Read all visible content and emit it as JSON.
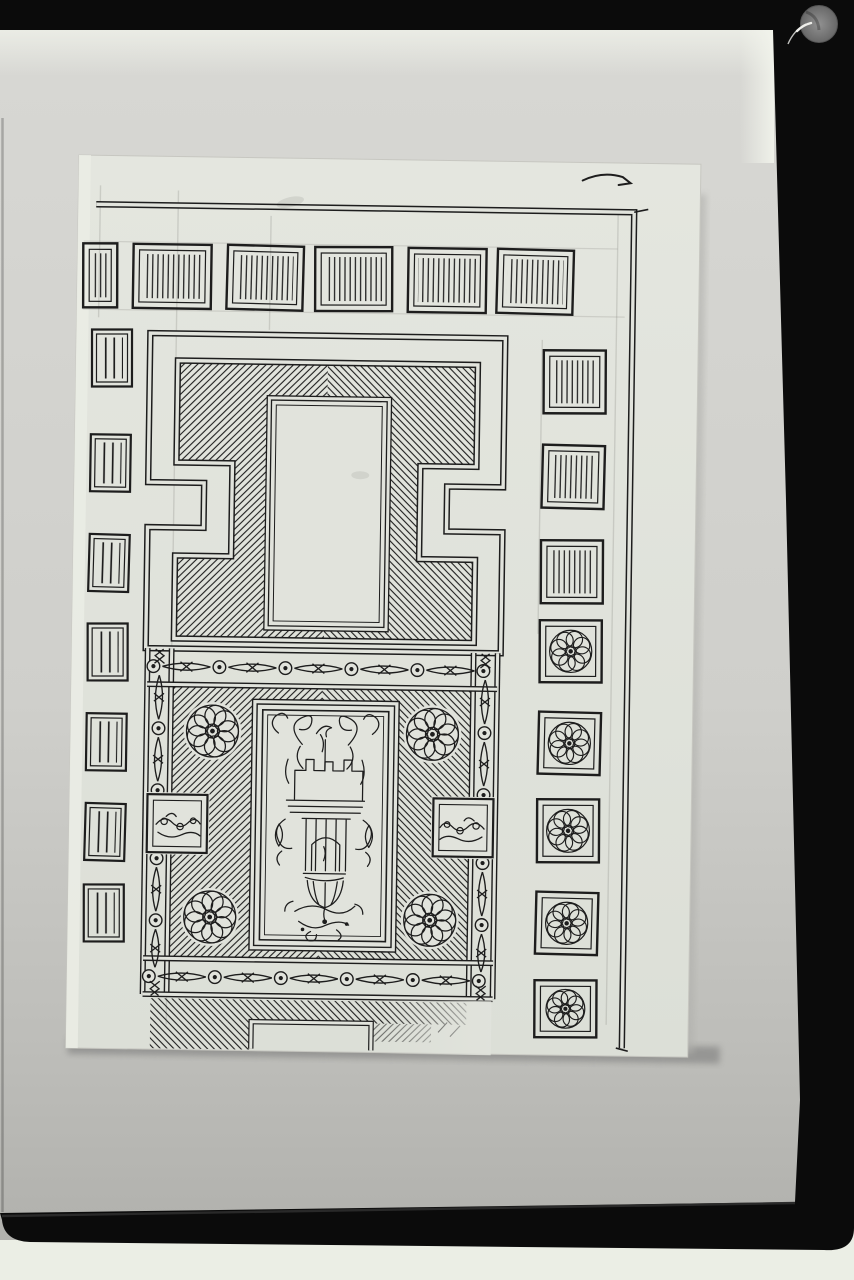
{
  "meta": {
    "medium": "black-and-white archival photograph",
    "subject": "pen-and-ink ornamental coffered ceiling design drawing on a film mount"
  },
  "palette": {
    "photo_bg_top": "#d8d8d4",
    "photo_bg_mid": "#cfcfcb",
    "photo_bg_low": "#bdbdb9",
    "photo_bg_bottom": "#aeaeaa",
    "film_black": "#0b0b0b",
    "film_sheen": "#2f2f2f",
    "pale_strip": "#ebeee5",
    "paper": "#e1e3dc",
    "paper_edge": "#eaece4",
    "ink": "#1d1d1d",
    "pencil": "#8a8a84",
    "shadow": "#8f8f8d",
    "grommet_light": "#919191",
    "grommet_dark": "#686868",
    "scratch_white": "#eeeeea",
    "highlight_white": "#f2f4ec"
  },
  "drawing": {
    "frieze_panel_count": 6,
    "left_column_panel_count": 7,
    "right_column_hatched_count": 3,
    "right_column_rosette_count": 5,
    "field_rosette_count": 4,
    "band_circle_count": 6,
    "upper_motif": "stepped greek-key meander frame with mitred diagonal hatching around a blank cartouche",
    "lower_motif": "guilloche ribbon borders, four reserved rosettes and a candelabra grotesque panel",
    "border_motif": "coffer squares with vertical hatching and rosette coffers",
    "state": "lower margin left unfinished"
  }
}
